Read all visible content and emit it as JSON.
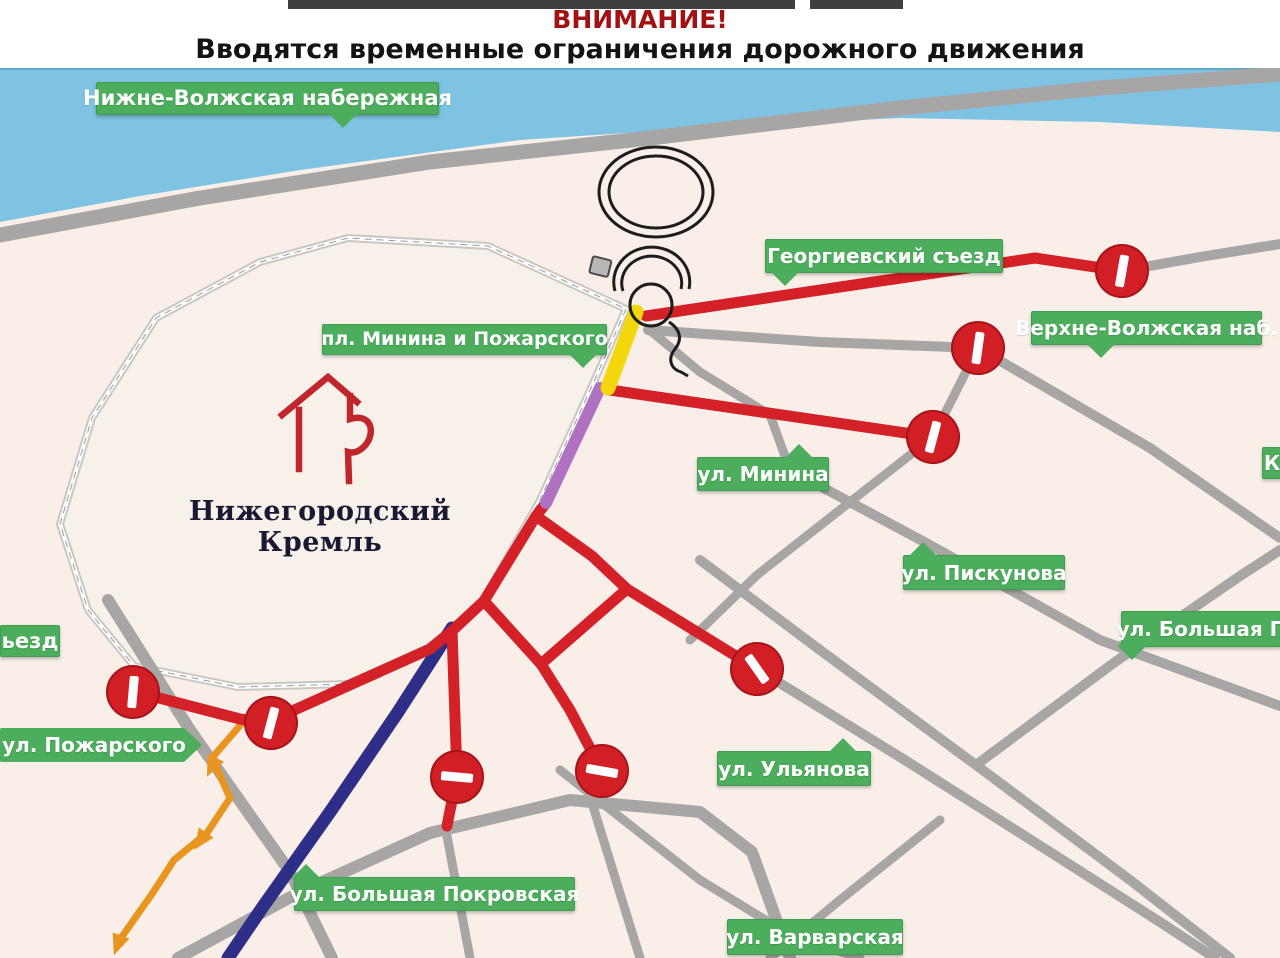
{
  "header": {
    "warning": "ВНИМАНИЕ!",
    "subtitle": "Вводятся временные ограничения дорожного движения"
  },
  "map": {
    "kremlin_label": "Нижегородский Кремль",
    "colors": {
      "land": "#f9efe8",
      "water": "#7fc3e2",
      "water_edge": "#5fa8c8",
      "road_gray": "#a7a6a4",
      "road_red": "#d32127",
      "label_green": "#4cae5c",
      "wall_gray": "#c9c7c3",
      "route_navy": "#2c2e88",
      "route_purple": "#b171c2",
      "route_yellow": "#f4d60d",
      "route_orange": "#e8941f",
      "sign_red": "#d21f26",
      "header_red": "#a31212"
    },
    "icons": {
      "no_entry": "no-entry-sign",
      "chkalov": "spiral-staircase-landmark",
      "kremlin_emblem": "kremlin-tower-emblem"
    },
    "water": {
      "pts": [
        [
          0,
          68
        ],
        [
          1280,
          68
        ],
        [
          1280,
          132
        ],
        [
          1100,
          122
        ],
        [
          900,
          118
        ],
        [
          700,
          128
        ],
        [
          520,
          140
        ],
        [
          300,
          170
        ],
        [
          140,
          196
        ],
        [
          0,
          222
        ]
      ]
    },
    "kremlin_wall": {
      "pts": [
        [
          626,
          309
        ],
        [
          592,
          386
        ],
        [
          540,
          500
        ],
        [
          484,
          599
        ],
        [
          450,
          630
        ],
        [
          428,
          648
        ],
        [
          350,
          684
        ],
        [
          238,
          687
        ],
        [
          134,
          666
        ],
        [
          88,
          610
        ],
        [
          60,
          524
        ],
        [
          92,
          418
        ],
        [
          156,
          318
        ],
        [
          260,
          262
        ],
        [
          348,
          238
        ],
        [
          488,
          246
        ]
      ]
    },
    "roads_gray": [
      {
        "name": "road-embankment",
        "w": 15,
        "pts": [
          [
            0,
            235
          ],
          [
            200,
            198
          ],
          [
            430,
            162
          ],
          [
            650,
            138
          ],
          [
            900,
            108
          ],
          [
            1100,
            88
          ],
          [
            1280,
            74
          ]
        ]
      },
      {
        "name": "road-georgievsky-cont",
        "w": 10,
        "pts": [
          [
            1122,
            271
          ],
          [
            1200,
            257
          ],
          [
            1280,
            244
          ]
        ]
      },
      {
        "name": "road-verkhnevolzhskaya",
        "w": 10,
        "pts": [
          [
            648,
            330
          ],
          [
            820,
            342
          ],
          [
            978,
            348
          ],
          [
            1150,
            448
          ],
          [
            1280,
            538
          ]
        ]
      },
      {
        "name": "road-cross-minina",
        "w": 9,
        "pts": [
          [
            978,
            348
          ],
          [
            933,
            437
          ],
          [
            850,
            502
          ],
          [
            757,
            575
          ],
          [
            690,
            640
          ]
        ]
      },
      {
        "name": "road-ulyanova-cont",
        "w": 10,
        "pts": [
          [
            757,
            669
          ],
          [
            900,
            757
          ],
          [
            1050,
            852
          ],
          [
            1160,
            922
          ],
          [
            1215,
            958
          ]
        ]
      },
      {
        "name": "road-piskunova",
        "w": 10,
        "pts": [
          [
            790,
            470
          ],
          [
            930,
            545
          ],
          [
            1100,
            640
          ],
          [
            1280,
            706
          ]
        ]
      },
      {
        "name": "road-bolshaya-pecherskaya",
        "w": 10,
        "pts": [
          [
            980,
            762
          ],
          [
            1115,
            662
          ],
          [
            1240,
            576
          ],
          [
            1280,
            550
          ]
        ]
      },
      {
        "name": "road-grid-diag",
        "w": 10,
        "pts": [
          [
            700,
            560
          ],
          [
            820,
            650
          ],
          [
            980,
            768
          ],
          [
            1130,
            880
          ],
          [
            1230,
            958
          ]
        ]
      },
      {
        "name": "road-junction-connector",
        "w": 9,
        "pts": [
          [
            652,
            332
          ],
          [
            700,
            372
          ],
          [
            770,
            415
          ],
          [
            790,
            470
          ]
        ]
      },
      {
        "name": "road-zelensky",
        "w": 12,
        "pts": [
          [
            108,
            600
          ],
          [
            190,
            730
          ],
          [
            290,
            872
          ],
          [
            332,
            958
          ]
        ]
      },
      {
        "name": "road-bottom-arc",
        "w": 12,
        "pts": [
          [
            178,
            958
          ],
          [
            300,
            892
          ],
          [
            430,
            833
          ],
          [
            570,
            800
          ],
          [
            700,
            812
          ],
          [
            752,
            852
          ],
          [
            790,
            958
          ]
        ]
      },
      {
        "name": "road-bottom-branch-1",
        "w": 9,
        "pts": [
          [
            447,
            836
          ],
          [
            470,
            958
          ]
        ]
      },
      {
        "name": "road-bottom-branch-2",
        "w": 9,
        "pts": [
          [
            592,
            803
          ],
          [
            640,
            958
          ]
        ]
      },
      {
        "name": "road-varvarskaya",
        "w": 9,
        "pts": [
          [
            560,
            770
          ],
          [
            700,
            880
          ],
          [
            790,
            935
          ],
          [
            860,
            958
          ]
        ]
      },
      {
        "name": "road-grid-ne-bottom",
        "w": 9,
        "pts": [
          [
            940,
            820
          ],
          [
            840,
            900
          ],
          [
            770,
            958
          ]
        ]
      }
    ],
    "roads_red": [
      {
        "name": "road-georgievsky-closed",
        "w": 11,
        "pts": [
          [
            646,
            316
          ],
          [
            1035,
            258
          ],
          [
            1122,
            271
          ]
        ]
      },
      {
        "name": "road-minina-closed",
        "w": 11,
        "pts": [
          [
            610,
            390
          ],
          [
            933,
            437
          ]
        ]
      },
      {
        "name": "road-kremlin-south-west",
        "w": 11,
        "pts": [
          [
            546,
            503
          ],
          [
            536,
            516
          ],
          [
            484,
            601
          ],
          [
            452,
            631
          ],
          [
            430,
            649
          ],
          [
            352,
            684
          ],
          [
            290,
            712
          ],
          [
            271,
            723
          ],
          [
            240,
            719
          ],
          [
            136,
            692
          ]
        ]
      },
      {
        "name": "road-to-ulyanova-closed",
        "w": 11,
        "pts": [
          [
            536,
            516
          ],
          [
            592,
            556
          ],
          [
            627,
            589
          ],
          [
            757,
            669
          ]
        ]
      },
      {
        "name": "road-diamond-lower",
        "w": 11,
        "pts": [
          [
            484,
            601
          ],
          [
            541,
            664
          ],
          [
            627,
            589
          ]
        ]
      },
      {
        "name": "road-spoke-east-closed",
        "w": 11,
        "pts": [
          [
            541,
            664
          ],
          [
            570,
            710
          ],
          [
            602,
            771
          ]
        ]
      },
      {
        "name": "road-spoke-west-closed",
        "w": 11,
        "pts": [
          [
            452,
            631
          ],
          [
            457,
            775
          ],
          [
            447,
            826
          ]
        ]
      }
    ],
    "special_routes": [
      {
        "name": "route-navy",
        "color": "#2c2e88",
        "w": 13,
        "pts": [
          [
            452,
            628
          ],
          [
            398,
            712
          ],
          [
            330,
            812
          ],
          [
            262,
            908
          ],
          [
            228,
            958
          ]
        ]
      },
      {
        "name": "route-orange",
        "color": "#e8941f",
        "w": 7,
        "pts": [
          [
            243,
            722
          ],
          [
            212,
            758
          ],
          [
            230,
            798
          ],
          [
            207,
            833
          ],
          [
            174,
            860
          ],
          [
            152,
            894
          ],
          [
            121,
            938
          ]
        ]
      },
      {
        "name": "route-purple",
        "color": "#b171c2",
        "w": 12,
        "pts": [
          [
            600,
            388
          ],
          [
            546,
            503
          ]
        ]
      },
      {
        "name": "route-yellow",
        "color": "#f4d60d",
        "w": 15,
        "pts": [
          [
            636,
            312
          ],
          [
            608,
            388
          ]
        ]
      }
    ],
    "orange_arrows": [
      {
        "x": 212,
        "y": 766,
        "a": 205
      },
      {
        "x": 201,
        "y": 840,
        "a": 215
      },
      {
        "x": 118,
        "y": 944,
        "a": 200
      }
    ],
    "signs": [
      {
        "x": 1122,
        "y": 271,
        "rot": 10
      },
      {
        "x": 978,
        "y": 348,
        "rot": 8
      },
      {
        "x": 933,
        "y": 437,
        "rot": 15
      },
      {
        "x": 757,
        "y": 669,
        "rot": -35
      },
      {
        "x": 602,
        "y": 771,
        "rot": 100
      },
      {
        "x": 457,
        "y": 777,
        "rot": 95
      },
      {
        "x": 271,
        "y": 723,
        "rot": 15
      },
      {
        "x": 133,
        "y": 692,
        "rot": 5
      }
    ],
    "street_labels": [
      {
        "id": "nizhnevolzhskaya",
        "text": "Нижне-Волжская набережная",
        "x": 96,
        "y": 82,
        "w": 341,
        "h": 31,
        "fs": 21,
        "ptr": "down",
        "at": 0.72
      },
      {
        "id": "georgievsky",
        "text": "Георгиевский съезд",
        "x": 765,
        "y": 239,
        "w": 236,
        "h": 32,
        "fs": 20,
        "ptr": "down",
        "at": 0.08
      },
      {
        "id": "verkhnevolzhskaya",
        "text": "Верхне-Волжская наб.",
        "x": 1031,
        "y": 311,
        "w": 229,
        "h": 32,
        "fs": 20,
        "ptr": "down",
        "at": 0.3
      },
      {
        "id": "pl-minina",
        "text": "пл. Минина и Пожарского",
        "x": 322,
        "y": 324,
        "w": 283,
        "h": 29,
        "fs": 19,
        "ptr": "down",
        "at": 0.92
      },
      {
        "id": "minina",
        "text": "ул. Минина",
        "x": 697,
        "y": 457,
        "w": 130,
        "h": 32,
        "fs": 20,
        "ptr": "up",
        "at": 0.78
      },
      {
        "id": "piskunova",
        "text": "ул. Пискунова",
        "x": 903,
        "y": 555,
        "w": 160,
        "h": 33,
        "fs": 20,
        "ptr": "up",
        "at": 0.12
      },
      {
        "id": "bolshaya-pecherskaya",
        "text": "ул. Большая П",
        "x": 1121,
        "y": 611,
        "w": 159,
        "h": 34,
        "fs": 20,
        "ptr": "down",
        "at": 0.06
      },
      {
        "id": "ulyanova",
        "text": "ул. Ульянова",
        "x": 717,
        "y": 751,
        "w": 152,
        "h": 33,
        "fs": 20,
        "ptr": "up",
        "at": 0.82
      },
      {
        "id": "pozharskogo",
        "text": "ул. Пожарского",
        "x": 0,
        "y": 728,
        "w": 188,
        "h": 34,
        "fs": 20,
        "ptr": "arrow-right",
        "at": 1
      },
      {
        "id": "bolshaya-pokrovskaya",
        "text": "ул. Большая Покровская",
        "x": 294,
        "y": 877,
        "w": 279,
        "h": 32,
        "fs": 20,
        "ptr": "up",
        "at": 0.04
      },
      {
        "id": "varvarskaya",
        "text": "ул. Варварская",
        "x": 727,
        "y": 919,
        "w": 174,
        "h": 34,
        "fs": 20,
        "ptr": "none",
        "at": 0
      },
      {
        "id": "syezd-partial",
        "text": "ьезд",
        "x": 0,
        "y": 625,
        "w": 58,
        "h": 30,
        "fs": 21,
        "ptr": "none",
        "at": 0
      },
      {
        "id": "k-partial",
        "text": "К",
        "x": 1262,
        "y": 447,
        "w": 18,
        "h": 30,
        "fs": 20,
        "ptr": "none",
        "at": 0
      }
    ],
    "topbars": [
      {
        "x": 288,
        "w": 507
      },
      {
        "x": 810,
        "w": 93
      }
    ]
  }
}
